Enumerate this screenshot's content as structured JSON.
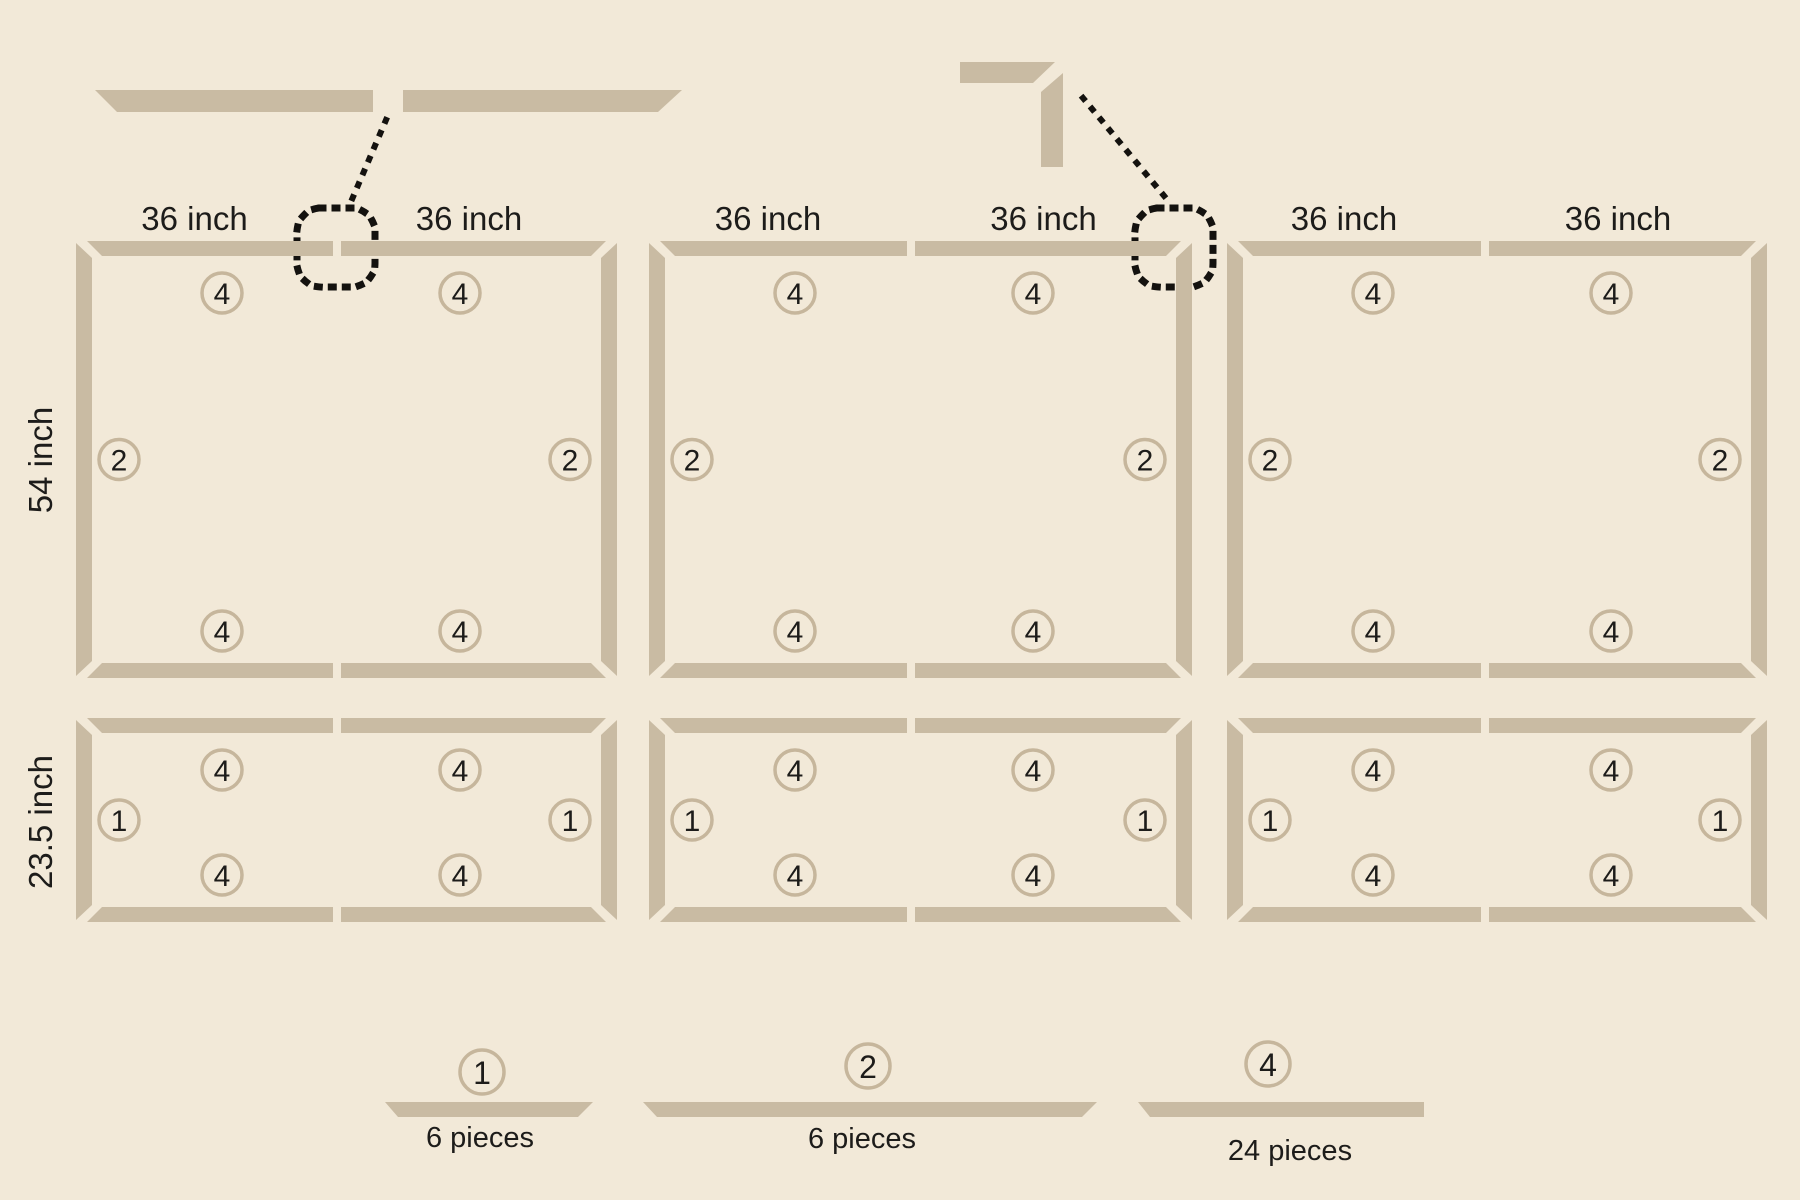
{
  "colors": {
    "background": "#f2e9d8",
    "board": "#c9bba3",
    "circle_stroke": "#c6b69c",
    "text": "#1d1c1a",
    "callout": "#14120f"
  },
  "dimension_labels": {
    "bay_width": "36 inch",
    "row1_height": "54 inch",
    "row2_height": "23.5 inch"
  },
  "piece_badges": {
    "rail": "4",
    "long_stile": "2",
    "short_stile": "1"
  },
  "legend": {
    "items": [
      {
        "badge": "1",
        "count_label": "6 pieces"
      },
      {
        "badge": "2",
        "count_label": "6 pieces"
      },
      {
        "badge": "4",
        "count_label": "24 pieces"
      }
    ]
  }
}
